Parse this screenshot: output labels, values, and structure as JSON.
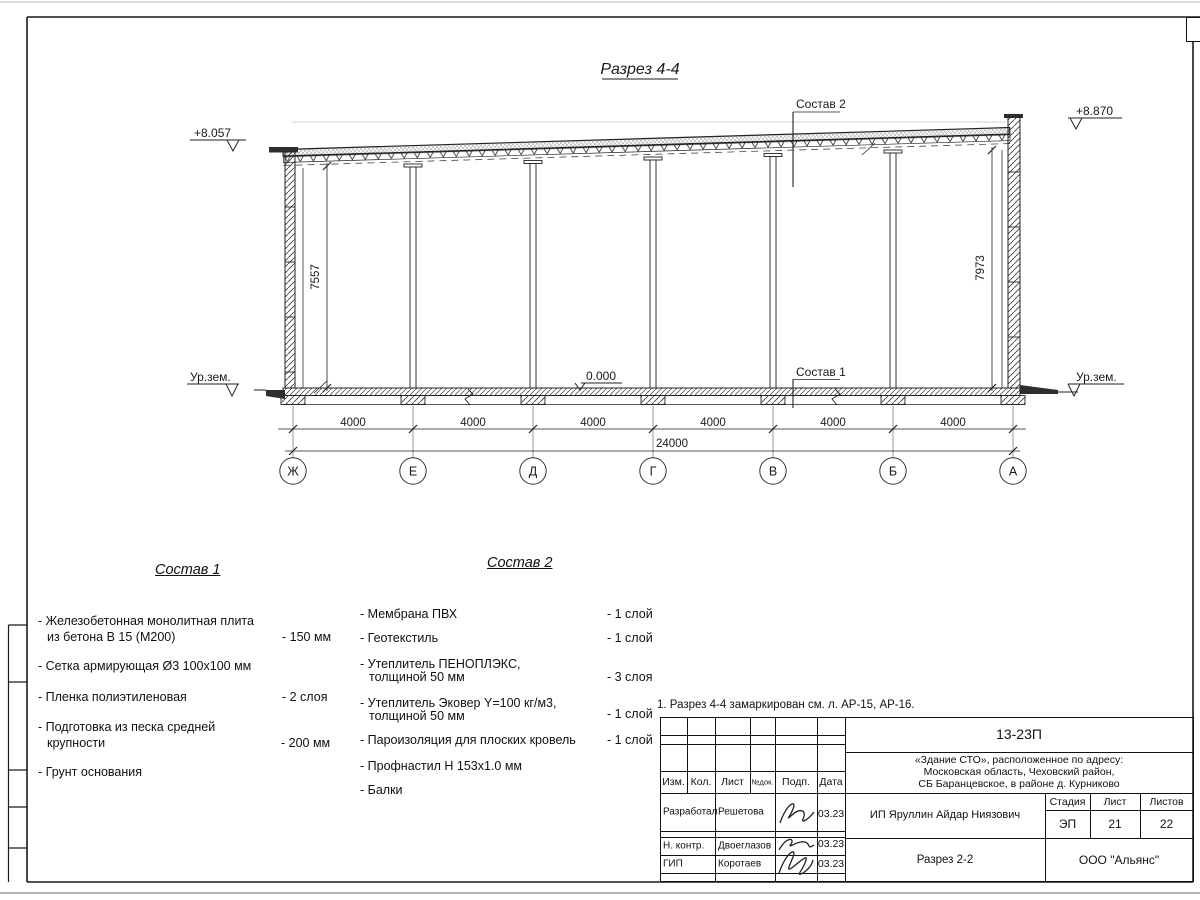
{
  "sheet": {
    "title": "Разрез 4-4",
    "note": "1. Разрез 4-4 замаркирован см. л. АР-15, АР-16."
  },
  "drawing": {
    "elev_left": "+8.057",
    "elev_right": "+8.870",
    "ground_left": "Ур.зем.",
    "ground_right": "Ур.зем.",
    "zero_level": "0.000",
    "label_comp1": "Состав 1",
    "label_comp2": "Состав 2",
    "dim_left": "7557",
    "dim_right": "7973",
    "dim_total": "24000",
    "dim_segments": [
      "4000",
      "4000",
      "4000",
      "4000",
      "4000",
      "4000"
    ],
    "axes": [
      "Ж",
      "Е",
      "Д",
      "Г",
      "В",
      "Б",
      "А"
    ]
  },
  "comp1": {
    "title": "Состав 1",
    "items": [
      {
        "l1": "- Железобетонная  монолитная плита",
        "l2": "из бетона В 15 (М200)",
        "val": "- 150 мм"
      },
      {
        "l1": "- Сетка армирующая Ø3 100х100 мм",
        "l2": "",
        "val": ""
      },
      {
        "l1": "- Пленка полиэтиленовая",
        "l2": "",
        "val": "-  2 слоя"
      },
      {
        "l1": "- Подготовка из песка средней",
        "l2": "крупности",
        "val": "- 200 мм"
      },
      {
        "l1": "- Грунт основания",
        "l2": "",
        "val": ""
      }
    ]
  },
  "comp2": {
    "title": "Состав 2",
    "items": [
      {
        "l1": "- Мембрана ПВХ",
        "l2": "",
        "val": "- 1 слой"
      },
      {
        "l1": "- Геотекстиль",
        "l2": "",
        "val": "- 1 слой"
      },
      {
        "l1": "- Утеплитель ПЕНОПЛЭКС,",
        "l2": "толщиной 50 мм",
        "val": "- 3 слоя"
      },
      {
        "l1": "- Утеплитель Эковер Y=100 кг/м3,",
        "l2": "толщиной 50 мм",
        "val": "- 1 слой"
      },
      {
        "l1": "- Пароизоляция для плоских кровель",
        "l2": "",
        "val": "- 1 слой"
      },
      {
        "l1": "- Профнастил Н 153х1.0 мм",
        "l2": "",
        "val": ""
      },
      {
        "l1": "- Балки",
        "l2": "",
        "val": ""
      }
    ]
  },
  "titleblock": {
    "doc_number": "13-23П",
    "project_line1": "«Здание СТО», расположенное по адресу:",
    "project_line2": "Московская область, Чеховский район,",
    "project_line3": "СБ Баранцевское, в районе д. Курниково",
    "col_izm": "Изм.",
    "col_kol": "Кол.",
    "col_list": "Лист",
    "col_ndok": "№док.",
    "col_podp": "Подп.",
    "col_data": "Дата",
    "rows": [
      {
        "role": "Разработал",
        "name": "Решетова",
        "date": "03.23"
      },
      {
        "role": "Н. контр.",
        "name": "Двоеглазов",
        "date": "03.23"
      },
      {
        "role": "ГИП",
        "name": "Коротаев",
        "date": "03.23"
      }
    ],
    "client": "ИП Яруллин Айдар Ниязович",
    "sheet_title": "Разрез 2-2",
    "stage_label": "Стадия",
    "sheet_label": "Лист",
    "sheets_label": "Листов",
    "stage": "ЭП",
    "sheet_no": "21",
    "sheets_total": "22",
    "company": "ООО \"Альянс\""
  },
  "colors": {
    "line": "#1a1a1a",
    "faint": "#c0c0c0"
  }
}
